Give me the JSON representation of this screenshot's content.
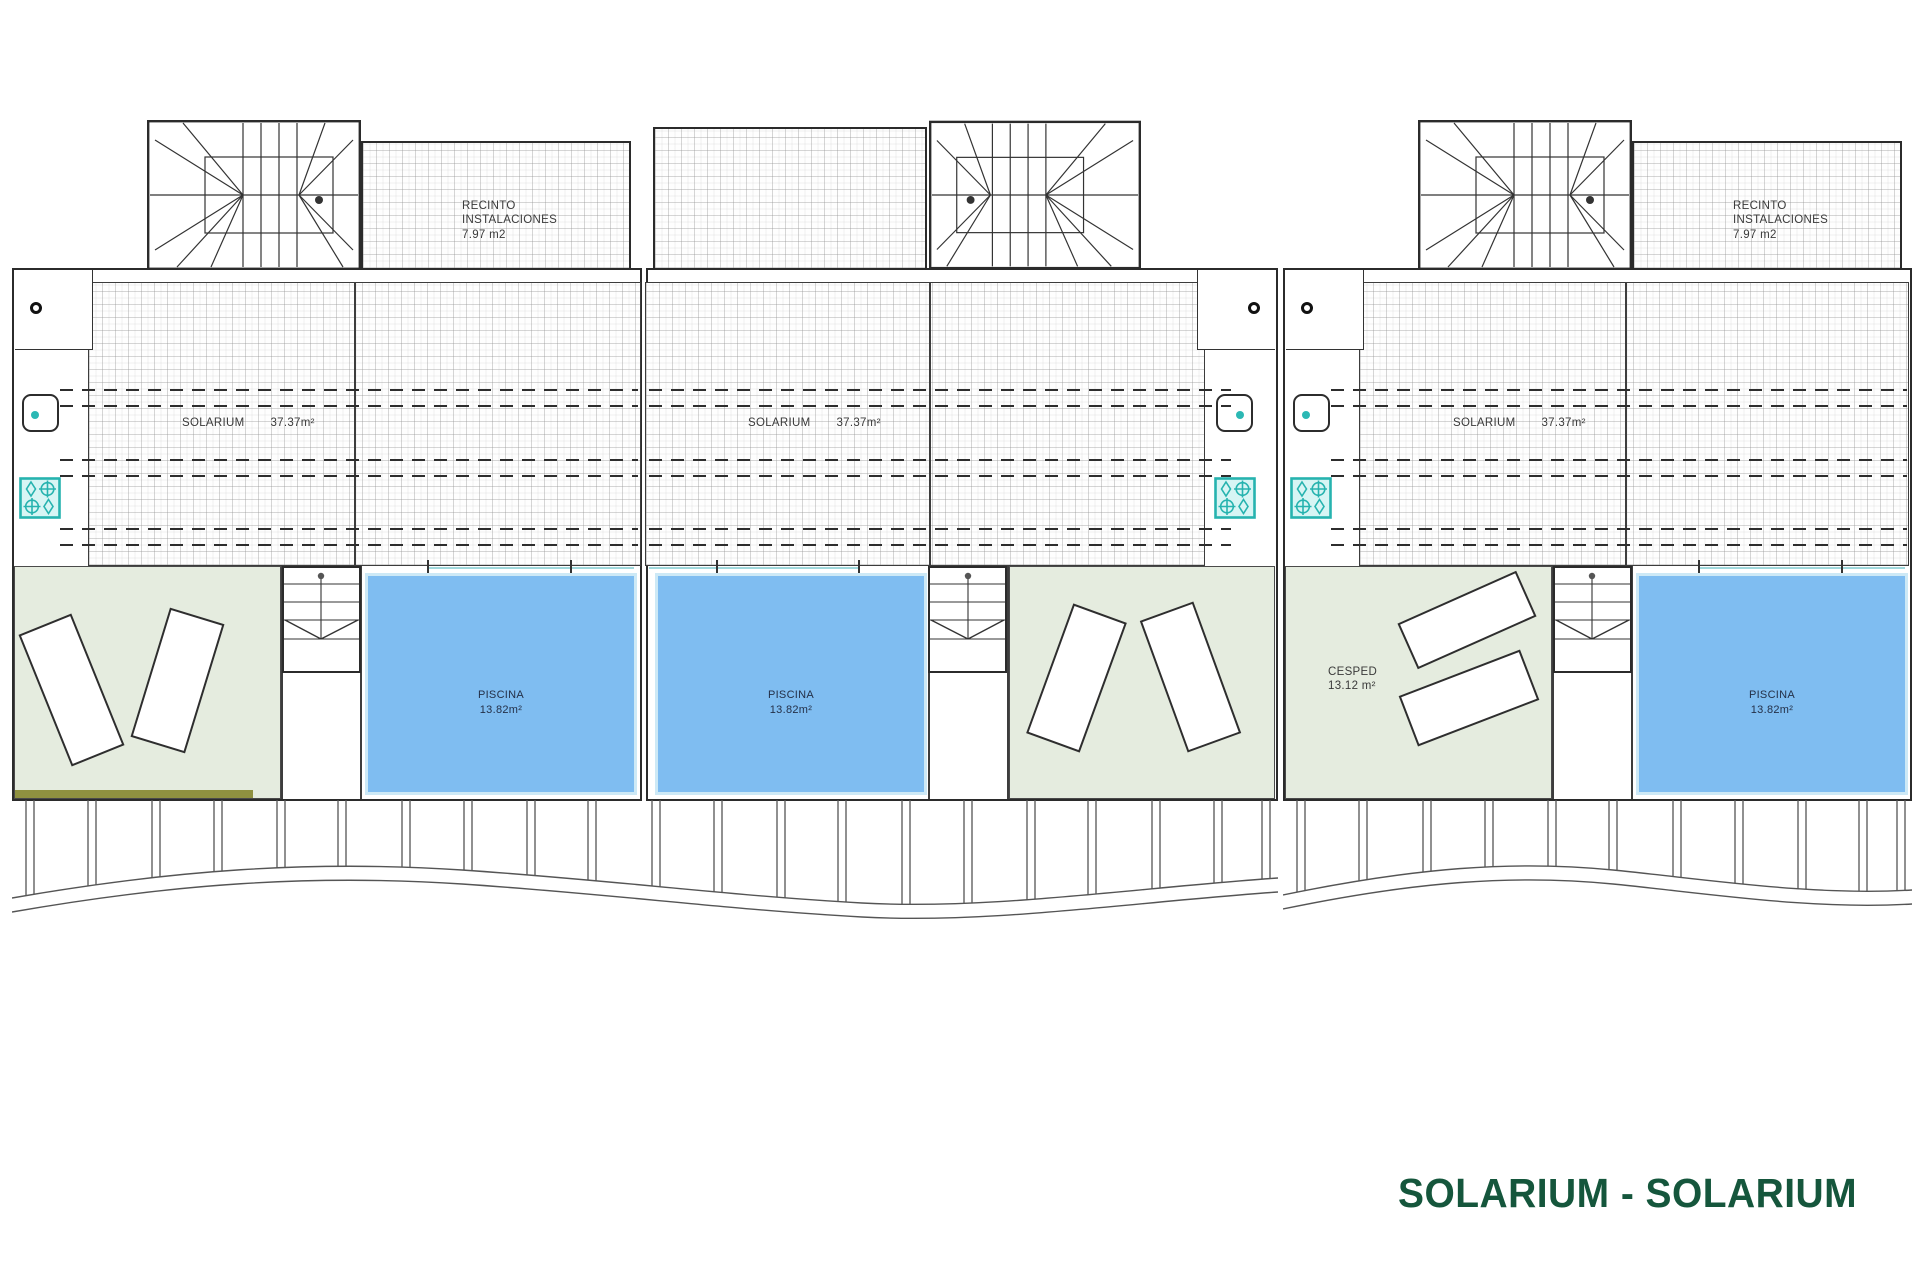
{
  "plan": {
    "title": "SOLARIUM - SOLARIUM"
  },
  "units": [
    {
      "name": "Unit 1",
      "solarium": {
        "label": "SOLARIUM",
        "area": "37.37m²"
      },
      "pool": {
        "label": "PISCINA",
        "area": "13.82m²"
      },
      "recinto": {
        "line1": "RECINTO",
        "line2": "INSTALACIONES",
        "line3": "7.97 m2"
      }
    },
    {
      "name": "Unit 2",
      "solarium": {
        "label": "SOLARIUM",
        "area": "37.37m²"
      },
      "pool": {
        "label": "PISCINA",
        "area": "13.82m²"
      }
    },
    {
      "name": "Unit 3",
      "solarium": {
        "label": "SOLARIUM",
        "area": "37.37m²"
      },
      "pool": {
        "label": "PISCINA",
        "area": "13.82m²"
      },
      "lawn": {
        "label": "CESPED",
        "area": "13.12 m²"
      },
      "recinto": {
        "line1": "RECINTO",
        "line2": "INSTALACIONES",
        "line3": "7.97 m2"
      }
    }
  ],
  "icons": {
    "hob-icon": "four-burner outdoor hob (teal circles and diamonds)",
    "sink-icon": "rounded square basin with teal dot",
    "round-fixture-icon": "small black ring",
    "stairwell-plan-icon": "winder staircase with radiating treads",
    "pool-stair-icon": "straight stair with down arrow"
  },
  "colors": {
    "pool_fill": "#7fbdf1",
    "pool_edge": "#cde9f6",
    "pool_waterline": "#9fd8dc",
    "grass_fill": "#e5ecdf",
    "hedge_olive": "#8f9140",
    "fixture_teal": "#2bb8b4",
    "wall_line": "#2b2b2b",
    "title_green": "#15563c"
  }
}
